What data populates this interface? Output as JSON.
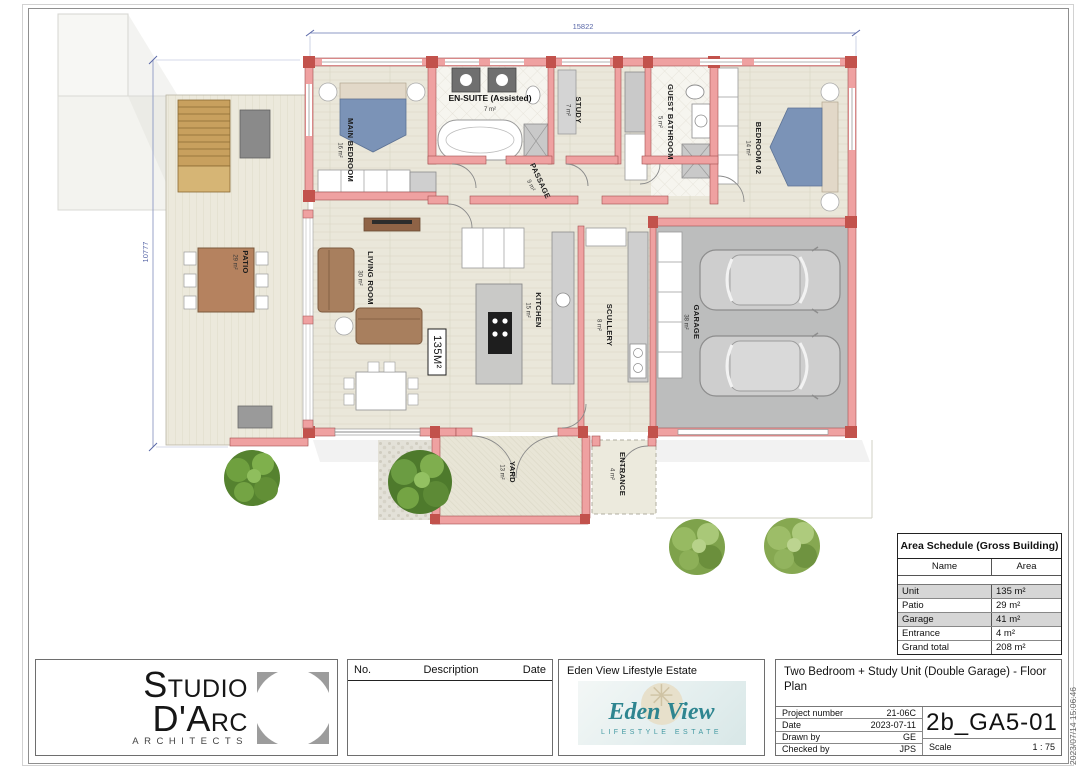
{
  "sheet": {
    "timestamp": "2023/07/14 15:06:46"
  },
  "dimensions": {
    "top": "15822",
    "left": "10777"
  },
  "plan": {
    "unit_area_box": "135M²",
    "rooms": {
      "main_bedroom": {
        "name": "MAIN BEDROOM",
        "area": "16 m²"
      },
      "en_suite": {
        "name": "EN-SUITE (Assisted)",
        "area": "7 m²"
      },
      "study": {
        "name": "STUDY",
        "area": "7 m²"
      },
      "guest_bathroom": {
        "name": "GUEST BATHROOM",
        "area": "5 m²"
      },
      "bedroom_02": {
        "name": "BEDROOM 02",
        "area": "14 m²"
      },
      "passage": {
        "name": "PASSAGE",
        "area": "9 m²"
      },
      "patio": {
        "name": "PATIO",
        "area": "29 m²"
      },
      "living_room": {
        "name": "LIVING ROOM",
        "area": "30 m²"
      },
      "kitchen": {
        "name": "KITCHEN",
        "area": "15 m²"
      },
      "scullery": {
        "name": "SCULLERY",
        "area": "8 m²"
      },
      "garage": {
        "name": "GARAGE",
        "area": "38 m²"
      },
      "yard": {
        "name": "YARD",
        "area": "13 m²"
      },
      "entrance": {
        "name": "ENTRANCE",
        "area": "4 m²"
      }
    }
  },
  "area_schedule": {
    "title": "Area Schedule (Gross Building)",
    "columns": [
      "Name",
      "Area"
    ],
    "rows": [
      {
        "name": "Unit",
        "area": "135 m²"
      },
      {
        "name": "Patio",
        "area": "29 m²"
      },
      {
        "name": "Garage",
        "area": "41 m²"
      },
      {
        "name": "Entrance",
        "area": "4 m²"
      },
      {
        "name": "Grand total",
        "area": "208 m²"
      }
    ]
  },
  "revision_table": {
    "headers": [
      "No.",
      "Description",
      "Date"
    ]
  },
  "architect": {
    "name": "Studio D'Arc",
    "tagline": "ARCHITECTS"
  },
  "client": {
    "header": "Eden View Lifestyle Estate",
    "logo_script": "Eden View",
    "logo_tag": "LIFESTYLE ESTATE"
  },
  "title_block": {
    "drawing_title": "Two Bedroom + Study Unit (Double Garage)  - Floor Plan",
    "fields": [
      {
        "label": "Project number",
        "value": "21-06C"
      },
      {
        "label": "Date",
        "value": "2023-07-11"
      },
      {
        "label": "Drawn by",
        "value": "GE"
      },
      {
        "label": "Checked by",
        "value": "JPS"
      }
    ],
    "drawing_number": "2b_GA5-01",
    "scale_label": "Scale",
    "scale_value": "1 : 75"
  },
  "colors": {
    "wall_pink": "#efa1a1",
    "wall_dark": "#c2524c",
    "teal": "#2e8590",
    "logo_gray": "#9c9c9c",
    "bed_blue": "#7b93b7",
    "sofa_brown": "#a87f5e"
  }
}
